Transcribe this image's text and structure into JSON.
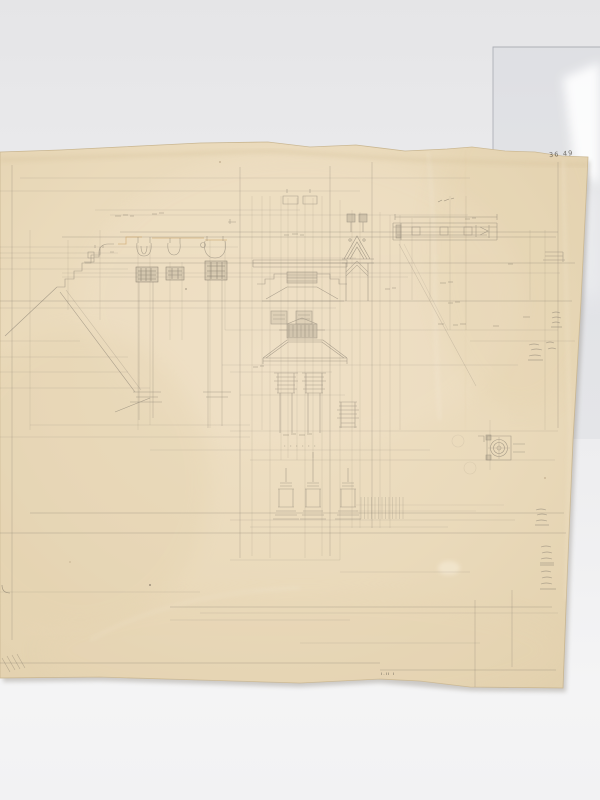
{
  "scene": {
    "description": "Photograph of an aged sheet of cream tracing paper bearing a faint graphite working drawing of Gothic architectural details - moulding and capital profiles, a central pinnacle and gablet study, a beam section, a small circular plan detail and arithmetic jottings - lying on a grey surface with a clear acetate sheet behind its top-right corner",
    "background_color": "#e8e8ea",
    "lower_background_color": "#f4f4f5",
    "paper_color": "#e9d9ba",
    "paper_edge_color": "#c9b691",
    "pencil_color": "#7e766a",
    "pencil_dark_color": "#5d574d",
    "ochre_accent_color": "#c49a58",
    "acetate_edge_color": "#a3a6ad"
  },
  "paper": {
    "sheet_number": "36 49",
    "bottom_edge_mark": "ı.ıı ı"
  }
}
